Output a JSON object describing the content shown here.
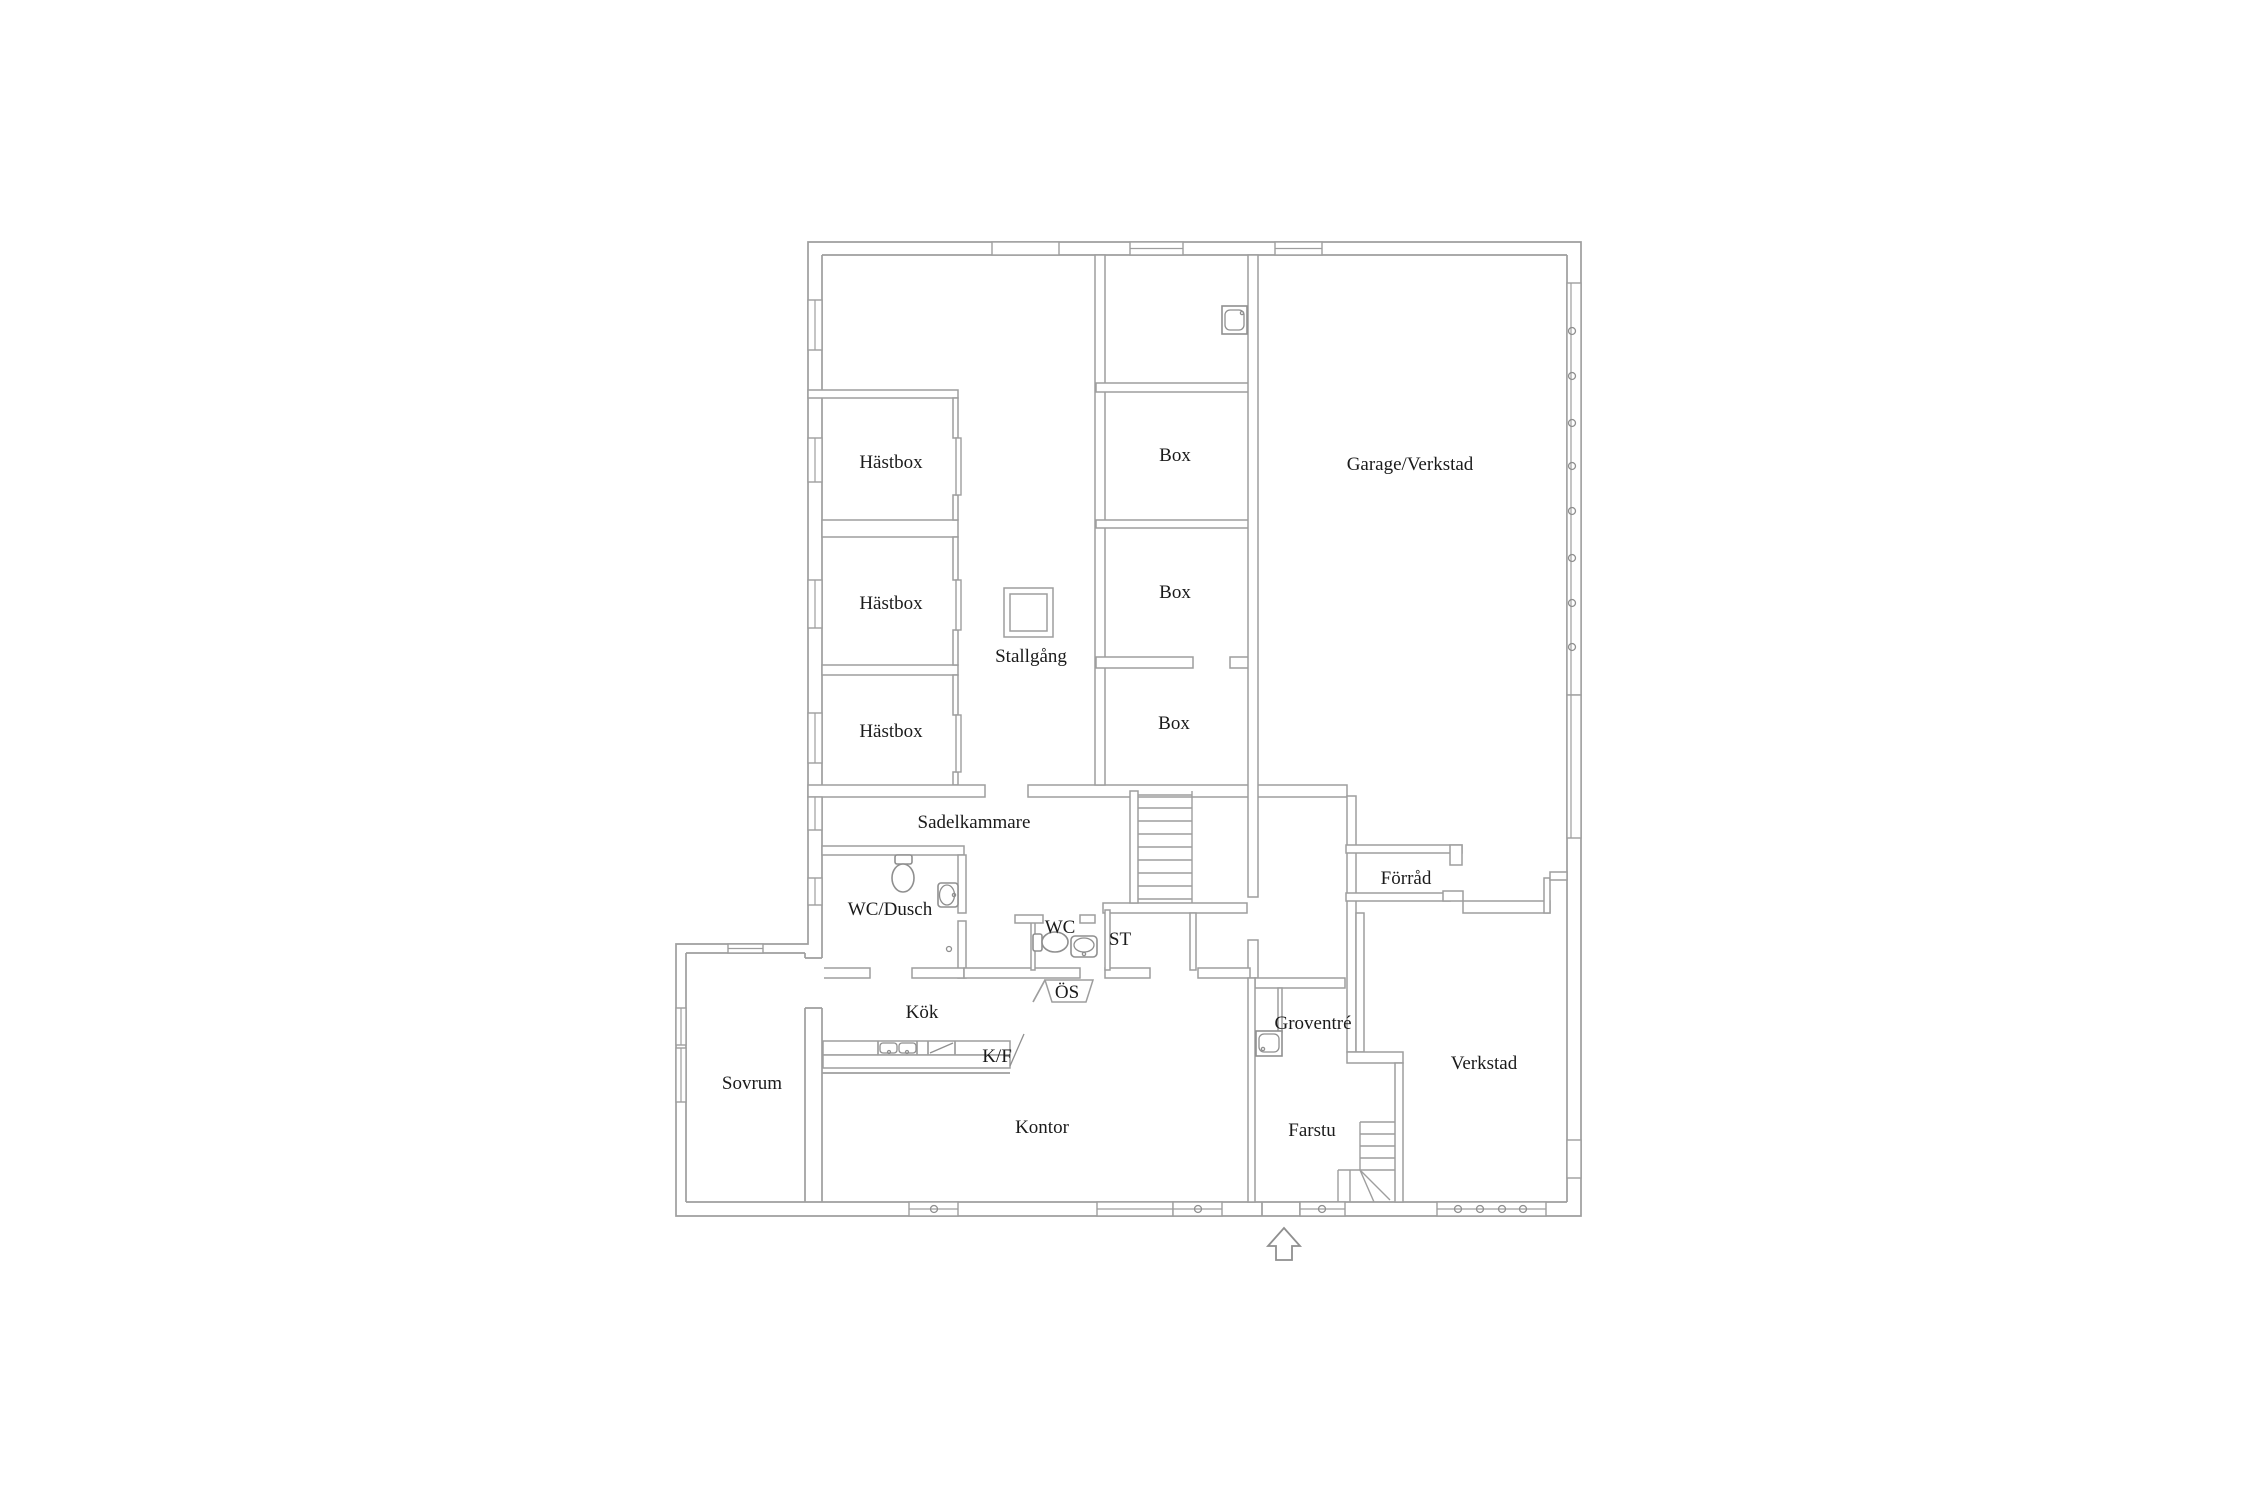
{
  "plan": {
    "title": "Stable and workshop floor plan",
    "language": "sv",
    "colors": {
      "background": "#ffffff",
      "wall": "#9e9e9e",
      "text": "#1b1b1b"
    },
    "rooms": [
      {
        "id": "hastbox-1",
        "label": "Hästbox"
      },
      {
        "id": "hastbox-2",
        "label": "Hästbox"
      },
      {
        "id": "hastbox-3",
        "label": "Hästbox"
      },
      {
        "id": "box-1",
        "label": "Box"
      },
      {
        "id": "box-2",
        "label": "Box"
      },
      {
        "id": "box-3",
        "label": "Box"
      },
      {
        "id": "stallgang",
        "label": "Stallgång"
      },
      {
        "id": "garage-verkstad",
        "label": "Garage/Verkstad"
      },
      {
        "id": "sadelkammare",
        "label": "Sadelkammare"
      },
      {
        "id": "wc-dusch",
        "label": "WC/Dusch"
      },
      {
        "id": "wc",
        "label": "WC"
      },
      {
        "id": "st",
        "label": "ST"
      },
      {
        "id": "os",
        "label": "ÖS"
      },
      {
        "id": "kok",
        "label": "Kök"
      },
      {
        "id": "kf",
        "label": "K/F"
      },
      {
        "id": "sovrum",
        "label": "Sovrum"
      },
      {
        "id": "kontor",
        "label": "Kontor"
      },
      {
        "id": "groventre",
        "label": "Groventré"
      },
      {
        "id": "farstu",
        "label": "Farstu"
      },
      {
        "id": "verkstad",
        "label": "Verkstad"
      },
      {
        "id": "forrad",
        "label": "Förråd"
      }
    ],
    "fixtures": [
      "sink-icon",
      "toilet-icon",
      "wall-sink-icon",
      "toilet-icon",
      "corner-sink-icon",
      "double-kitchen-sink-icon",
      "stove-icon",
      "fridge-freezer-door-icon",
      "sink-icon"
    ],
    "stairs": [
      "main-staircase",
      "farstu-winder-staircase"
    ],
    "entrance": {
      "symbol": "arrow-up"
    }
  }
}
